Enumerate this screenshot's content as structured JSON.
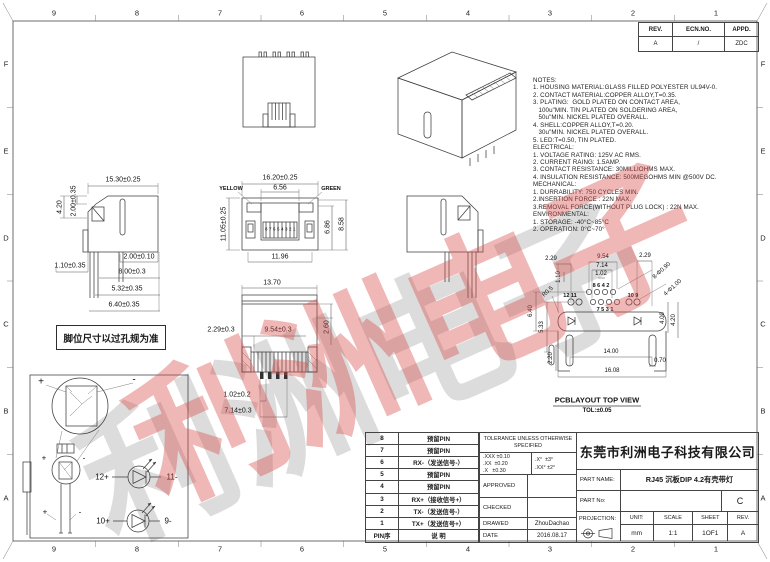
{
  "sheet": {
    "border": {
      "columns": [
        "9",
        "8",
        "7",
        "6",
        "5",
        "4",
        "3",
        "2",
        "1"
      ],
      "rows": [
        "F",
        "E",
        "D",
        "C",
        "B",
        "A"
      ]
    },
    "watermark": "利洲电子"
  },
  "rev_table": {
    "headers": [
      "REV.",
      "ECN.NO.",
      "APPD."
    ],
    "values": [
      "A",
      "/",
      "ZDC"
    ]
  },
  "notes": {
    "lines": [
      "NOTES:",
      "1. HOUSING MATERIAL:GLASS FILLED POLYESTER UL94V-0.",
      "2. CONTACT MATERIAL:COPPER ALLOY,T=0.35.",
      "3. PLATING:  GOLD PLATED ON CONTACT AREA,",
      "   100u\"MIN. TIN PLATED ON SOLDERING AREA,",
      "   50u\"MIN. NICKEL PLATED OVERALL.",
      "4. SHELL:COPPER ALLOY,T=0.20.",
      "   30u\"MIN. NICKEL PLATED OVERALL.",
      "5. LED:T=0.50, TIN PLATED.",
      "ELECTRICAL:",
      "1. VOLTAGE RATING: 125V AC RMS.",
      "2. CURRENT RAING: 1.5AMP.",
      "3. CONTACT RESISTANCE: 30MILLIOHMS MAX.",
      "4. INSULATION RESISTANCE: 500MEGOHMS MIN @500V DC.",
      "MECHANICAL:",
      "1. DURRABILITY: 750 CYCLES MIN.",
      "2.INSERTION FORCE : 22N MAX.",
      "3.REMOVAL FORCE(WITHOUT PLUG LOCK) : 22N MAX.",
      "ENVIRONMENTAL:",
      "1. STORAGE: -40°C~85°C",
      "2. OPERATION: 0°C~70°"
    ]
  },
  "views": {
    "side_left": {
      "dims": {
        "w": "15.30±0.25",
        "h1": "2.00±0.35",
        "h2": "4.20",
        "d1": "1.10±0.35",
        "d2": "2.00±0.10",
        "d3": "8.00±0.3",
        "d4": "5.32±0.35",
        "d5": "6.40±0.35"
      }
    },
    "front": {
      "led_left": "YELLOW",
      "led_right": "GREEN",
      "pins": "87654321",
      "dims": {
        "w": "16.20±0.25",
        "w2": "6.56",
        "h": "11.05±0.25",
        "h2": "6.86",
        "h3": "8.58",
        "w3": "11.96"
      }
    },
    "bottom": {
      "dims": {
        "w": "13.70",
        "d1": "2.29±0.3",
        "d2": "9.54±0.3",
        "h": "2.60",
        "d3": "1.02±0.2",
        "d4": "7.14±0.3"
      }
    },
    "pcb": {
      "title": "PCBLAYOUT TOP VIEW",
      "tol": "TOL:±0.05",
      "pins_tl": "12 11",
      "pins_top": "8 6 4 2",
      "pins_tr": "10 9",
      "pins_bottom": "7 5 3 1",
      "dims": {
        "d1": "2.29",
        "d2": "9.54",
        "d3": "7.14",
        "d4": "1.02",
        "d5": "2.29",
        "holes_small": "8-Φ0.90",
        "holes_big": "4-Φ1.00",
        "d6": "1.10",
        "radius": "R0.5",
        "v1": "6.40",
        "v2": "5.33",
        "v3": "2.20",
        "w1": "14.00",
        "w2": "16.08",
        "d7": "0.70",
        "v4": "4.00",
        "v5": "4.20"
      }
    },
    "footnote": "脚位尺寸以过孔规为准",
    "led_detail": {
      "labels": {
        "led1_a": "12+",
        "led1_k": "11-",
        "led2_a": "10+",
        "led2_k": "9-"
      },
      "marks": {
        "p1": "+",
        "m1": "-",
        "p2": "+",
        "m2": "-",
        "p3": "+",
        "m3": "-"
      }
    }
  },
  "title_block": {
    "pin_table": {
      "header": {
        "pin": "PIN序",
        "desc": "说 明"
      },
      "rows": [
        {
          "pin": "8",
          "desc": "预留PIN"
        },
        {
          "pin": "7",
          "desc": "预留PIN"
        },
        {
          "pin": "6",
          "desc": "RX-（发送信号-）"
        },
        {
          "pin": "5",
          "desc": "预留PIN"
        },
        {
          "pin": "4",
          "desc": "预留PIN"
        },
        {
          "pin": "3",
          "desc": "RX+（接收信号+）"
        },
        {
          "pin": "2",
          "desc": "TX-（发送信号-）"
        },
        {
          "pin": "1",
          "desc": "TX+（发送信号+）"
        }
      ]
    },
    "tolerance": {
      "title_lines": [
        "TOLERANCE UNLESS",
        "OTHERWISE SPECIFIED"
      ],
      "linear": [
        ".XXX ±0.10",
        ".XX  ±0.20",
        ".X   ±0.30"
      ],
      "angular": [
        ".X°  ±3°",
        ".XX° ±2°"
      ]
    },
    "approval": {
      "rows": [
        {
          "label": "APPROVED",
          "value": ""
        },
        {
          "label": "CHECKED",
          "value": ""
        },
        {
          "label": "DRAWED",
          "value": "ZhouDachao"
        },
        {
          "label": "DATE",
          "value": "2016.08.17"
        }
      ]
    },
    "company": "东莞市利洲电子科技有限公司",
    "part_name": {
      "label": "PART NAME:",
      "value": "RJ45 沉板DIP 4.2有壳带灯"
    },
    "part_no": {
      "label": "PART No:",
      "value": "",
      "rev": "C"
    },
    "footer": {
      "projection_label": "PROJECTION:",
      "unit_label": "UNIT:",
      "unit": "mm",
      "scale_label": "SCALE",
      "scale": "1:1",
      "sheet_label": "SHEET",
      "sheet": "1OF1",
      "rev_label": "REV.",
      "rev": "A"
    }
  }
}
